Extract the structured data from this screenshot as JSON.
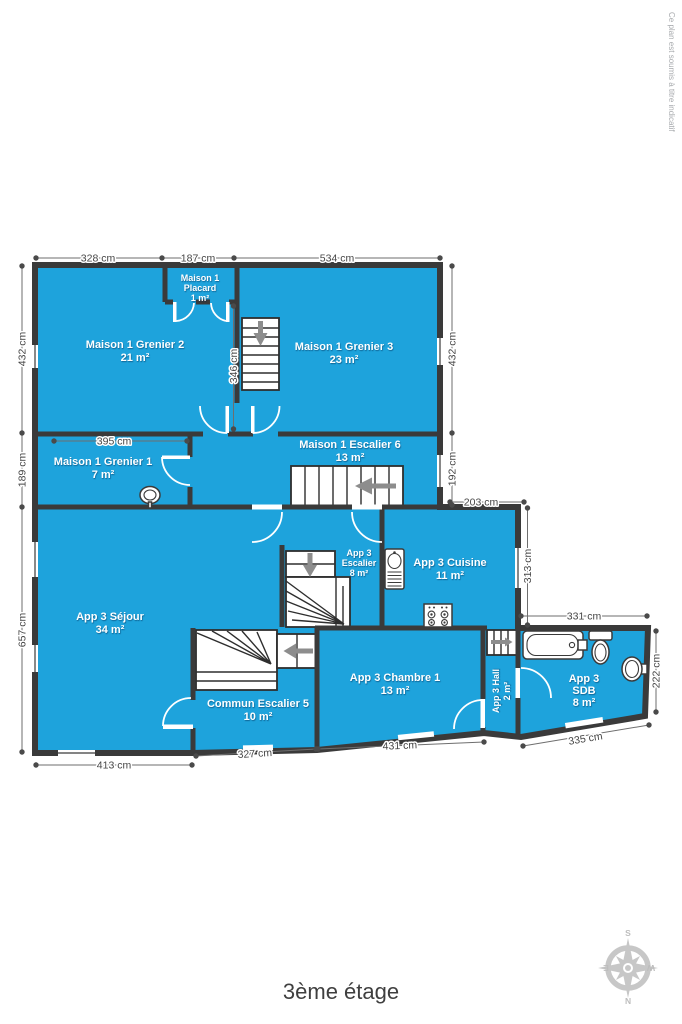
{
  "title": "3ème étage",
  "disclaimer": "Ce plan est soumis à titre indicatif",
  "colors": {
    "room_fill": "#1ea3dc",
    "wall": "#3a3a3a",
    "dim": "#454545",
    "room_text": "#ffffff",
    "compass": "#c7c7c7",
    "title_text": "#3f3f3f",
    "disclaimer_text": "#a8abae"
  },
  "rooms": [
    {
      "line1": "Maison 1",
      "line2": "Placard",
      "area": "1 m²"
    },
    {
      "line1": "Maison 1 Grenier 2",
      "area": "21 m²"
    },
    {
      "line1": "Maison 1 Grenier 3",
      "area": "23 m²"
    },
    {
      "line1": "Maison 1 Grenier 1",
      "area": "7 m²"
    },
    {
      "line1": "Maison 1 Escalier 6",
      "area": "13 m²"
    },
    {
      "line1": "App 3",
      "line2": "Escalier",
      "area": "8 m²"
    },
    {
      "line1": "App 3 Cuisine",
      "area": "11 m²"
    },
    {
      "line1": "App 3 Séjour",
      "area": "34 m²"
    },
    {
      "line1": "Commun Escalier 5",
      "area": "10 m²"
    },
    {
      "line1": "App 3 Chambre 1",
      "area": "13 m²"
    },
    {
      "line1": "App 3 Hall",
      "area": "2 m²"
    },
    {
      "line1": "App 3",
      "line2": "SDB",
      "area": "8 m²"
    }
  ],
  "dimensions": {
    "top": [
      "328 cm",
      "187 cm",
      "534 cm"
    ],
    "left": [
      "432 cm",
      "189 cm",
      "657 cm"
    ],
    "right": [
      "432 cm",
      "192 cm"
    ],
    "inner": [
      "346 cm",
      "395 cm",
      "203 cm",
      "313 cm"
    ],
    "sdb": [
      "331 cm",
      "222 cm",
      "335 cm"
    ],
    "bottom": [
      "413 cm",
      "327 cm",
      "431 cm"
    ]
  },
  "compass": {
    "n": "N",
    "e": "E",
    "s": "S",
    "w": "W"
  }
}
